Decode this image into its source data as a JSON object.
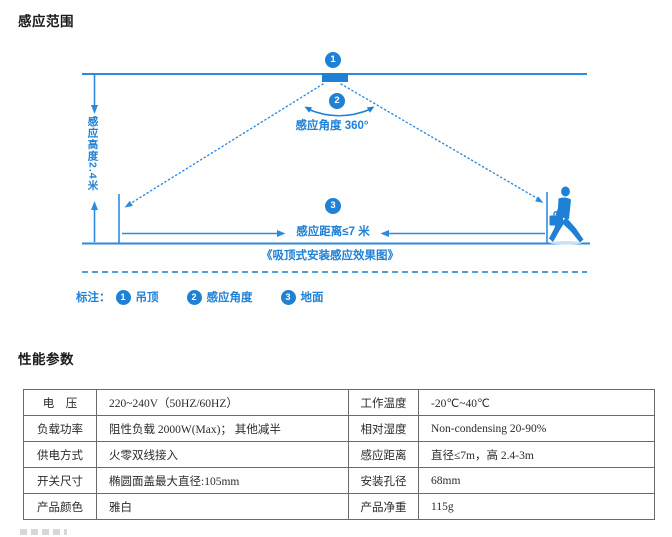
{
  "page": {
    "title1": "感应范围",
    "title2": "性能参数"
  },
  "diagram": {
    "angle_label": "感应角度 360°",
    "height_label": "感应高度2.4米",
    "distance_label": "感应距离≤7 米",
    "caption": "《吸顶式安装感应效果图》",
    "markers": {
      "one": "1",
      "two": "2",
      "three": "3"
    },
    "legend": {
      "prefix": "标注：",
      "items": [
        {
          "num": "1",
          "label": "吊顶"
        },
        {
          "num": "2",
          "label": "感应角度"
        },
        {
          "num": "3",
          "label": "地面"
        }
      ]
    },
    "icons": {
      "person": "walking-person-with-briefcase-icon"
    },
    "colors": {
      "accent_blue": "#1e81d6",
      "dashed_blue": "#4f9ad9"
    }
  },
  "spec_table": {
    "rows": [
      {
        "k1": "电　压",
        "v1": "220~240V（50HZ/60HZ）",
        "k2": "工作温度",
        "v2": "-20℃~40℃"
      },
      {
        "k1": "负载功率",
        "v1": "阻性负载 2000W(Max)； 其他减半",
        "k2": "相对湿度",
        "v2": "Non-condensing 20-90%"
      },
      {
        "k1": "供电方式",
        "v1": "火零双线接入",
        "k2": "感应距离",
        "v2": "直径≤7m，高 2.4-3m"
      },
      {
        "k1": "开关尺寸",
        "v1": "椭圆面盖最大直径:105mm",
        "k2": "安装孔径",
        "v2": "68mm"
      },
      {
        "k1": "产品颜色",
        "v1": "雅白",
        "k2": "产品净重",
        "v2": "115g"
      }
    ]
  }
}
